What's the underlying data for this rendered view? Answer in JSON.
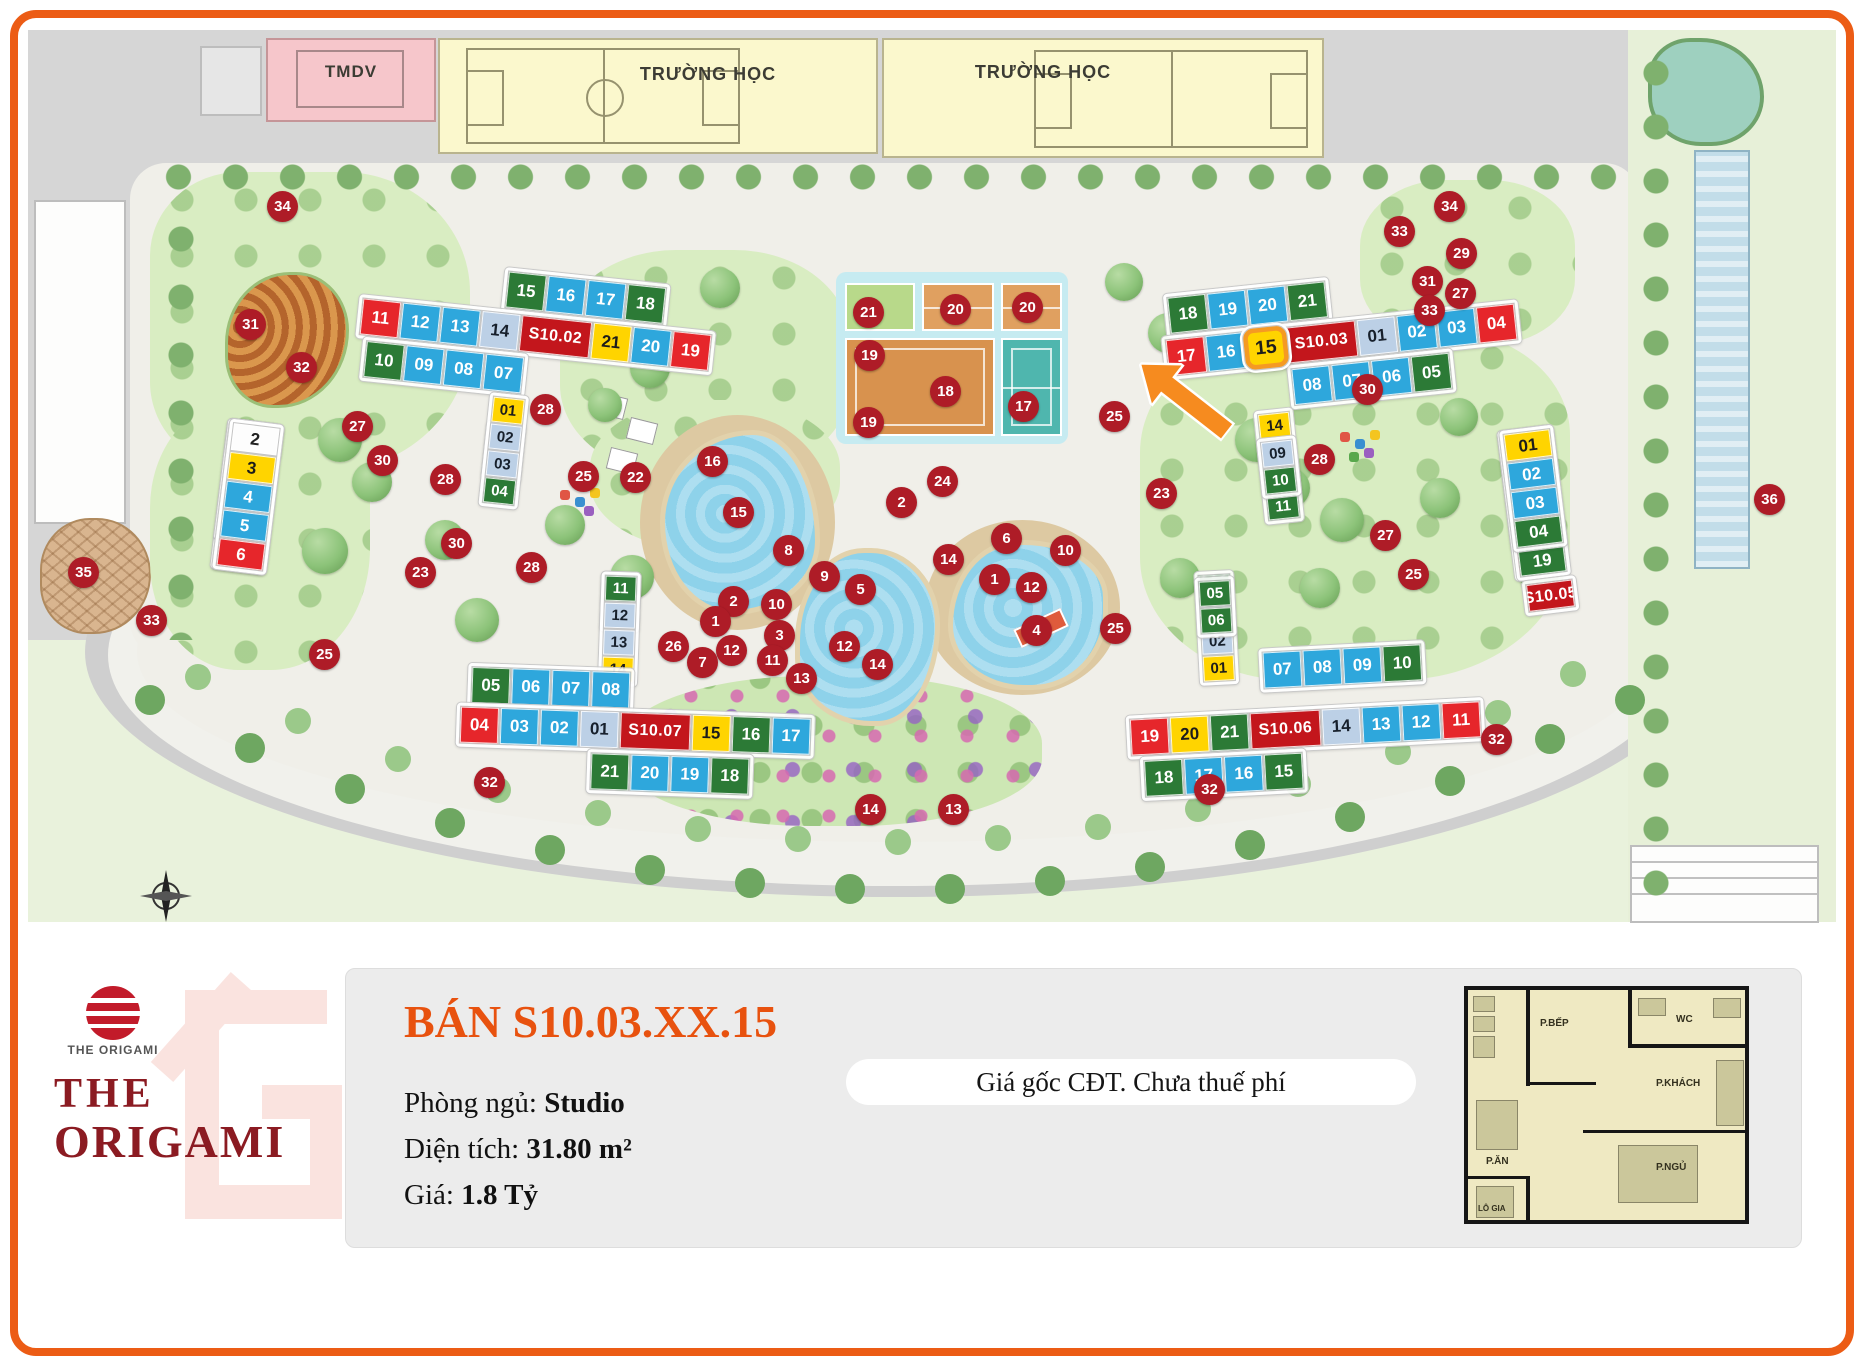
{
  "frame": {
    "border_color": "#EC5C15"
  },
  "map": {
    "zones": {
      "tmdv": "TMDV",
      "school1": "TRƯỜNG HỌC",
      "school2": "TRƯỜNG HỌC"
    },
    "markers": [
      {
        "t": "34",
        "x": 283,
        "y": 207
      },
      {
        "t": "31",
        "x": 251,
        "y": 325
      },
      {
        "t": "32",
        "x": 302,
        "y": 368
      },
      {
        "t": "27",
        "x": 358,
        "y": 427
      },
      {
        "t": "30",
        "x": 383,
        "y": 461
      },
      {
        "t": "28",
        "x": 446,
        "y": 480
      },
      {
        "t": "35",
        "x": 84,
        "y": 573
      },
      {
        "t": "33",
        "x": 152,
        "y": 621
      },
      {
        "t": "25",
        "x": 325,
        "y": 655
      },
      {
        "t": "32",
        "x": 490,
        "y": 783
      },
      {
        "t": "28",
        "x": 546,
        "y": 410
      },
      {
        "t": "22",
        "x": 636,
        "y": 478
      },
      {
        "t": "25",
        "x": 584,
        "y": 477
      },
      {
        "t": "30",
        "x": 457,
        "y": 544
      },
      {
        "t": "23",
        "x": 421,
        "y": 573
      },
      {
        "t": "28",
        "x": 532,
        "y": 568
      },
      {
        "t": "26",
        "x": 674,
        "y": 647
      },
      {
        "t": "21",
        "x": 869,
        "y": 313
      },
      {
        "t": "20",
        "x": 956,
        "y": 310
      },
      {
        "t": "20",
        "x": 1028,
        "y": 308
      },
      {
        "t": "19",
        "x": 870,
        "y": 356
      },
      {
        "t": "18",
        "x": 946,
        "y": 392
      },
      {
        "t": "17",
        "x": 1024,
        "y": 407
      },
      {
        "t": "19",
        "x": 869,
        "y": 423
      },
      {
        "t": "24",
        "x": 943,
        "y": 482
      },
      {
        "t": "2",
        "x": 902,
        "y": 503
      },
      {
        "t": "16",
        "x": 713,
        "y": 462
      },
      {
        "t": "15",
        "x": 739,
        "y": 513
      },
      {
        "t": "8",
        "x": 789,
        "y": 551
      },
      {
        "t": "9",
        "x": 825,
        "y": 577
      },
      {
        "t": "5",
        "x": 861,
        "y": 590
      },
      {
        "t": "2",
        "x": 734,
        "y": 602
      },
      {
        "t": "10",
        "x": 777,
        "y": 605
      },
      {
        "t": "1",
        "x": 716,
        "y": 622
      },
      {
        "t": "3",
        "x": 780,
        "y": 636
      },
      {
        "t": "12",
        "x": 732,
        "y": 651
      },
      {
        "t": "11",
        "x": 773,
        "y": 661
      },
      {
        "t": "7",
        "x": 703,
        "y": 663
      },
      {
        "t": "13",
        "x": 802,
        "y": 679
      },
      {
        "t": "12",
        "x": 845,
        "y": 647
      },
      {
        "t": "14",
        "x": 878,
        "y": 665
      },
      {
        "t": "6",
        "x": 1007,
        "y": 539
      },
      {
        "t": "10",
        "x": 1066,
        "y": 551
      },
      {
        "t": "14",
        "x": 949,
        "y": 560
      },
      {
        "t": "1",
        "x": 995,
        "y": 580
      },
      {
        "t": "12",
        "x": 1032,
        "y": 588
      },
      {
        "t": "4",
        "x": 1037,
        "y": 631
      },
      {
        "t": "25",
        "x": 1116,
        "y": 629
      },
      {
        "t": "23",
        "x": 1162,
        "y": 494
      },
      {
        "t": "25",
        "x": 1115,
        "y": 417
      },
      {
        "t": "28",
        "x": 1320,
        "y": 460
      },
      {
        "t": "30",
        "x": 1368,
        "y": 390
      },
      {
        "t": "34",
        "x": 1450,
        "y": 207
      },
      {
        "t": "33",
        "x": 1400,
        "y": 232
      },
      {
        "t": "29",
        "x": 1462,
        "y": 254
      },
      {
        "t": "31",
        "x": 1428,
        "y": 282
      },
      {
        "t": "27",
        "x": 1461,
        "y": 294
      },
      {
        "t": "33",
        "x": 1430,
        "y": 311
      },
      {
        "t": "36",
        "x": 1770,
        "y": 500
      },
      {
        "t": "27",
        "x": 1386,
        "y": 536
      },
      {
        "t": "25",
        "x": 1414,
        "y": 575
      },
      {
        "t": "32",
        "x": 1497,
        "y": 740
      },
      {
        "t": "32",
        "x": 1210,
        "y": 790
      },
      {
        "t": "14",
        "x": 871,
        "y": 810
      },
      {
        "t": "13",
        "x": 954,
        "y": 810
      }
    ],
    "buildings": {
      "s1001": {
        "colA1": [
          {
            "t": "15",
            "c": "g"
          },
          {
            "t": "14",
            "c": "l"
          },
          {
            "t": "13",
            "c": "b"
          },
          {
            "t": "12",
            "c": "b"
          },
          {
            "t": "11",
            "c": "g"
          }
        ],
        "colA2": [
          {
            "t": "10",
            "c": "y"
          },
          {
            "t": "9",
            "c": "b"
          },
          {
            "t": "8",
            "c": "b"
          },
          {
            "t": "7",
            "c": "g"
          }
        ],
        "colB1": [
          {
            "t": "16",
            "c": "g"
          },
          {
            "t": "17",
            "c": "l"
          },
          {
            "t": "18",
            "c": "l"
          },
          {
            "t": "19",
            "c": "y"
          },
          {
            "t": "1",
            "c": "g"
          }
        ],
        "label": [
          {
            "t": "S10.01",
            "c": "lab"
          }
        ],
        "colB2": [
          {
            "t": "2",
            "c": "w"
          },
          {
            "t": "3",
            "c": "y"
          },
          {
            "t": "4",
            "c": "b"
          },
          {
            "t": "5",
            "c": "b"
          },
          {
            "t": "6",
            "c": "r"
          }
        ]
      },
      "s1002": {
        "row1": [
          {
            "t": "15",
            "c": "g"
          },
          {
            "t": "16",
            "c": "b"
          },
          {
            "t": "17",
            "c": "b"
          },
          {
            "t": "18",
            "c": "g"
          }
        ],
        "row2": [
          {
            "t": "11",
            "c": "r"
          },
          {
            "t": "12",
            "c": "b"
          },
          {
            "t": "13",
            "c": "b"
          },
          {
            "t": "14",
            "c": "l"
          },
          {
            "t": "S10.02",
            "c": "lab"
          },
          {
            "t": "21",
            "c": "y"
          },
          {
            "t": "20",
            "c": "b"
          },
          {
            "t": "19",
            "c": "r"
          }
        ],
        "row3": [
          {
            "t": "10",
            "c": "g"
          },
          {
            "t": "09",
            "c": "b"
          },
          {
            "t": "08",
            "c": "b"
          },
          {
            "t": "07",
            "c": "b"
          }
        ],
        "colL": [
          {
            "t": "06",
            "c": "b"
          },
          {
            "t": "05",
            "c": "g"
          }
        ],
        "colR": [
          {
            "t": "01",
            "c": "y"
          },
          {
            "t": "02",
            "c": "l"
          },
          {
            "t": "03",
            "c": "l"
          },
          {
            "t": "04",
            "c": "g"
          }
        ]
      },
      "s1003": {
        "row1": [
          {
            "t": "18",
            "c": "g"
          },
          {
            "t": "19",
            "c": "b"
          },
          {
            "t": "20",
            "c": "b"
          },
          {
            "t": "21",
            "c": "g"
          }
        ],
        "row2": [
          {
            "t": "17",
            "c": "r"
          },
          {
            "t": "16",
            "c": "b"
          },
          {
            "t": "15",
            "c": "y",
            "hl": true
          },
          {
            "t": "S10.03",
            "c": "lab"
          },
          {
            "t": "01",
            "c": "l"
          },
          {
            "t": "02",
            "c": "b"
          },
          {
            "t": "03",
            "c": "b"
          },
          {
            "t": "04",
            "c": "r"
          }
        ],
        "row3": [
          {
            "t": "08",
            "c": "b"
          },
          {
            "t": "07",
            "c": "b"
          },
          {
            "t": "06",
            "c": "b"
          },
          {
            "t": "05",
            "c": "g"
          }
        ],
        "colL": [
          {
            "t": "14",
            "c": "y"
          },
          {
            "t": "13",
            "c": "l"
          },
          {
            "t": "12",
            "c": "l"
          },
          {
            "t": "11",
            "c": "g"
          }
        ],
        "colR": [
          {
            "t": "09",
            "c": "l"
          },
          {
            "t": "10",
            "c": "g"
          }
        ]
      },
      "s1007": {
        "colL": [
          {
            "t": "10",
            "c": "g"
          },
          {
            "t": "09",
            "c": "l"
          }
        ],
        "colR": [
          {
            "t": "11",
            "c": "g"
          },
          {
            "t": "12",
            "c": "l"
          },
          {
            "t": "13",
            "c": "l"
          },
          {
            "t": "14",
            "c": "y"
          }
        ],
        "row1": [
          {
            "t": "05",
            "c": "g"
          },
          {
            "t": "06",
            "c": "b"
          },
          {
            "t": "07",
            "c": "b"
          },
          {
            "t": "08",
            "c": "b"
          }
        ],
        "row2": [
          {
            "t": "04",
            "c": "r"
          },
          {
            "t": "03",
            "c": "b"
          },
          {
            "t": "02",
            "c": "b"
          },
          {
            "t": "01",
            "c": "l"
          },
          {
            "t": "S10.07",
            "c": "lab"
          },
          {
            "t": "15",
            "c": "y"
          },
          {
            "t": "16",
            "c": "g"
          },
          {
            "t": "17",
            "c": "b"
          }
        ],
        "row3": [
          {
            "t": "21",
            "c": "g"
          },
          {
            "t": "20",
            "c": "b"
          },
          {
            "t": "19",
            "c": "b"
          },
          {
            "t": "18",
            "c": "g"
          }
        ]
      },
      "s1006": {
        "colL": [
          {
            "t": "04",
            "c": "g"
          },
          {
            "t": "03",
            "c": "l"
          },
          {
            "t": "02",
            "c": "l"
          },
          {
            "t": "01",
            "c": "y"
          }
        ],
        "colR": [
          {
            "t": "05",
            "c": "g"
          },
          {
            "t": "06",
            "c": "g"
          }
        ],
        "row1": [
          {
            "t": "07",
            "c": "b"
          },
          {
            "t": "08",
            "c": "b"
          },
          {
            "t": "09",
            "c": "b"
          },
          {
            "t": "10",
            "c": "g"
          }
        ],
        "row2": [
          {
            "t": "19",
            "c": "r"
          },
          {
            "t": "20",
            "c": "y"
          },
          {
            "t": "21",
            "c": "g"
          },
          {
            "t": "S10.06",
            "c": "lab"
          },
          {
            "t": "14",
            "c": "l"
          },
          {
            "t": "13",
            "c": "b"
          },
          {
            "t": "12",
            "c": "b"
          },
          {
            "t": "11",
            "c": "r"
          }
        ],
        "row3": [
          {
            "t": "18",
            "c": "g"
          },
          {
            "t": "17",
            "c": "b"
          },
          {
            "t": "16",
            "c": "b"
          },
          {
            "t": "15",
            "c": "g"
          }
        ]
      },
      "s1005": {
        "colA1": [
          {
            "t": "14",
            "c": "g"
          },
          {
            "t": "13",
            "c": "l"
          },
          {
            "t": "12",
            "c": "l"
          },
          {
            "t": "11",
            "c": "y"
          }
        ],
        "colA2": [
          {
            "t": "09",
            "c": "l"
          },
          {
            "t": "08",
            "c": "y"
          },
          {
            "t": "07",
            "c": "g"
          },
          {
            "t": "06",
            "c": "g"
          },
          {
            "t": "05",
            "c": "r"
          }
        ],
        "colB1": [
          {
            "t": "15",
            "c": "g"
          },
          {
            "t": "16",
            "c": "l"
          },
          {
            "t": "17",
            "c": "b"
          },
          {
            "t": "18",
            "c": "b"
          },
          {
            "t": "19",
            "c": "g"
          }
        ],
        "colB2": [
          {
            "t": "01",
            "c": "y"
          },
          {
            "t": "02",
            "c": "b"
          },
          {
            "t": "03",
            "c": "b"
          },
          {
            "t": "04",
            "c": "g"
          }
        ],
        "label": [
          {
            "t": "S10.05",
            "c": "lab"
          }
        ]
      }
    }
  },
  "panel": {
    "title": "BÁN S10.03.XX.15",
    "fields": [
      {
        "label": "Phòng ngủ: ",
        "value": "Studio"
      },
      {
        "label": "Diện tích: ",
        "value": "31.80 m²"
      },
      {
        "label": "Giá: ",
        "value": "1.8 Tỷ"
      }
    ],
    "note": "Giá gốc CĐT. Chưa thuế phí"
  },
  "logo": {
    "brand_small": "THE ORIGAMI",
    "line1": "THE",
    "line2": "ORIGAMI"
  },
  "floorplan": {
    "bep": "P.BẾP",
    "wc": "WC",
    "khach": "P.KHÁCH",
    "an": "P.ĂN",
    "ngu": "P.NGỦ",
    "logia": "LÔ GIA"
  }
}
